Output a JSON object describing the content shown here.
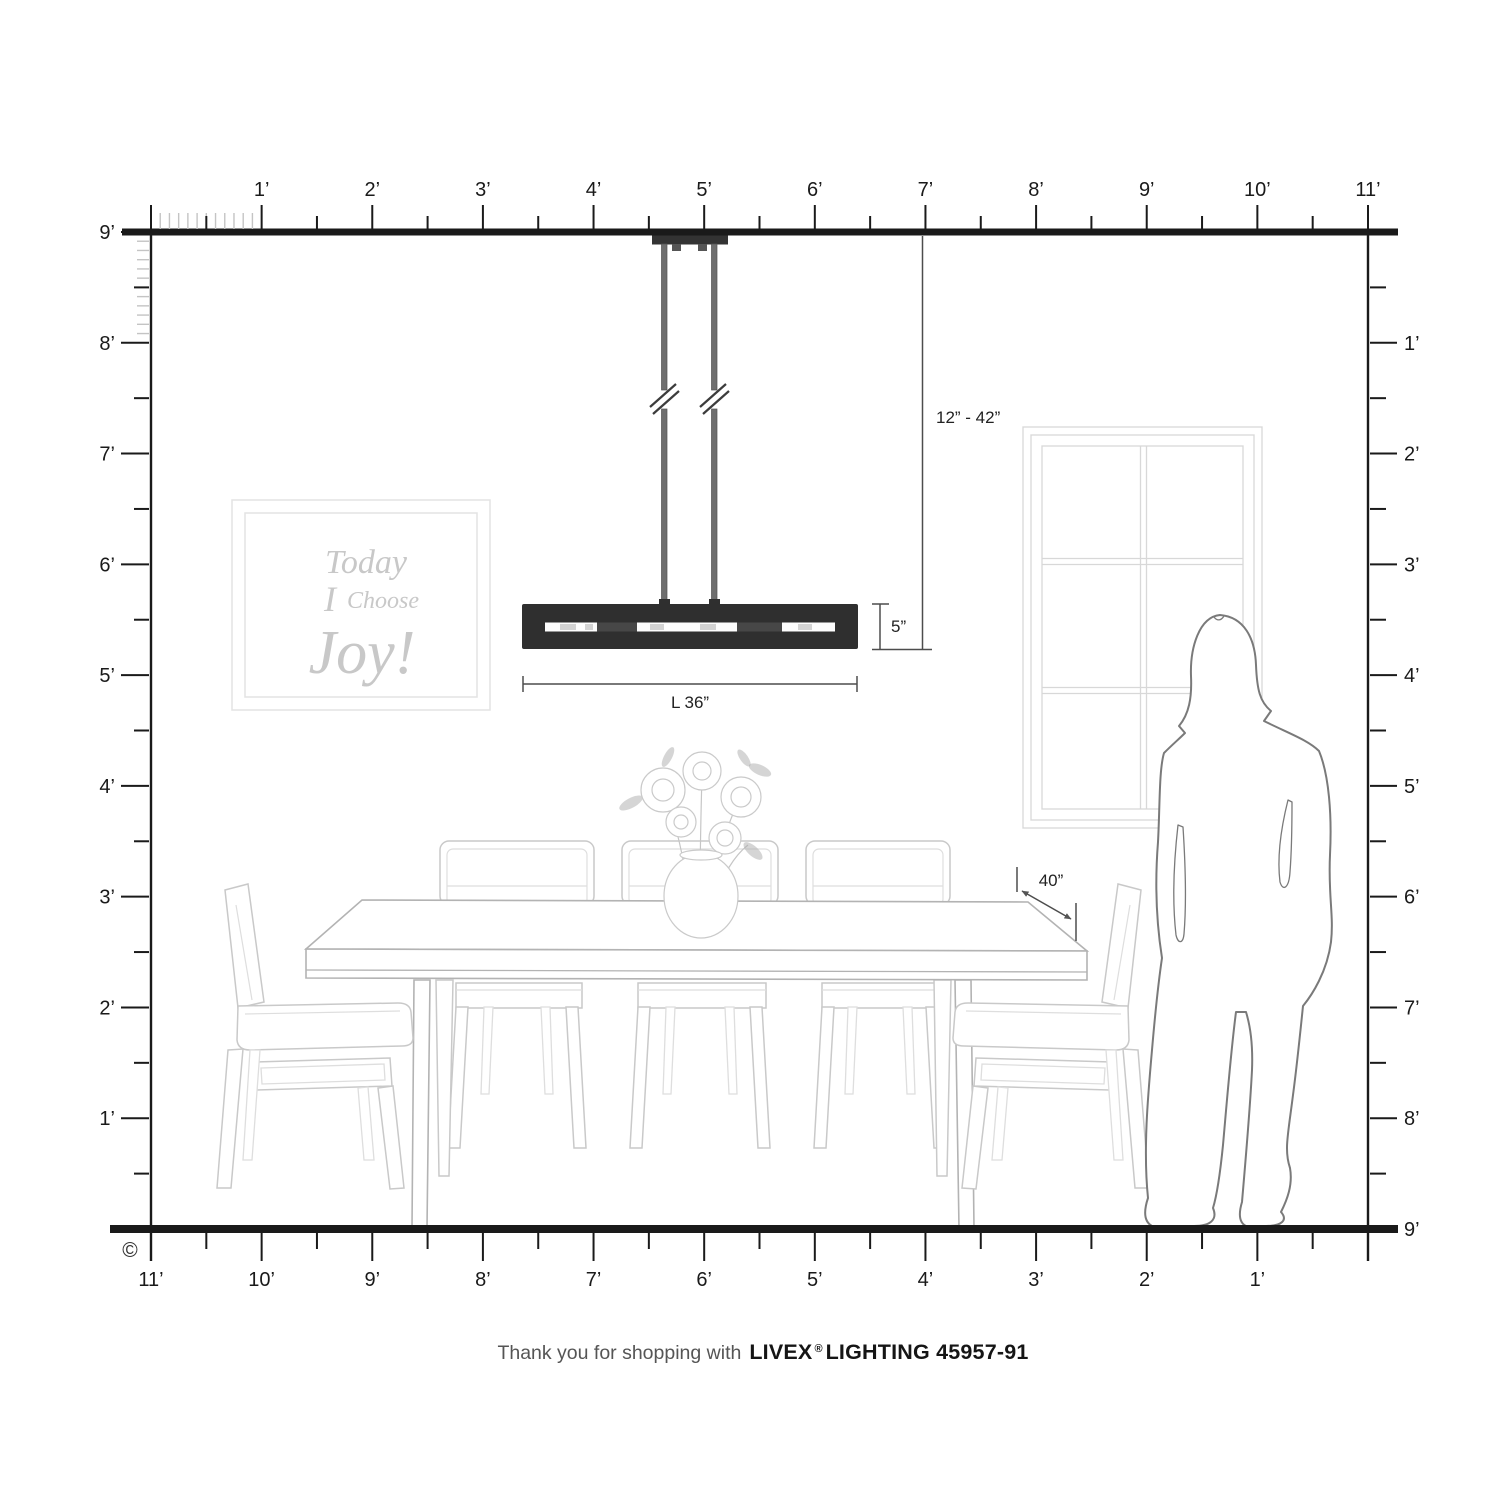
{
  "rulers": {
    "top": [
      "1’",
      "2’",
      "3’",
      "4’",
      "5’",
      "6’",
      "7’",
      "8’",
      "9’",
      "10’",
      "11’"
    ],
    "left": [
      "9’",
      "8’",
      "7’",
      "6’",
      "5’",
      "4’",
      "3’",
      "2’",
      "1’"
    ],
    "right": [
      "1’",
      "2’",
      "3’",
      "4’",
      "5’",
      "6’",
      "7’",
      "8’",
      "9’"
    ],
    "bottom": [
      "11’",
      "10’",
      "9’",
      "8’",
      "7’",
      "6’",
      "5’",
      "4’",
      "3’",
      "2’",
      "1’"
    ]
  },
  "dimensions": {
    "drop": "12” - 42”",
    "height": "5”",
    "length": "L 36”",
    "clearance": "40”"
  },
  "wall_art": {
    "line1": "Today",
    "line2_i": "I",
    "line2_choose": "Choose",
    "line3": "Joy!"
  },
  "footer": {
    "prefix": "Thank you for shopping with",
    "brand": "LIVEX",
    "reg": "®",
    "suffix": "LIGHTING 45957-91"
  },
  "copyright": "©",
  "colors": {
    "ink": "#1a1a1a",
    "inch_tick": "#c4c4c4",
    "fixture": "#2f2f2f",
    "rod": "#6e6e6e",
    "furniture_line": "#c9c9c9",
    "furniture_faint": "#dedede",
    "table_line": "#b3b3b3",
    "frame_line": "#e3e3e3",
    "art_text": "#c8c8c8",
    "window_line": "#d8d8d8",
    "woman_line": "#7a7a7a",
    "dim_line": "#4d4d4d",
    "text": "#222222",
    "footer_text": "#555555"
  }
}
